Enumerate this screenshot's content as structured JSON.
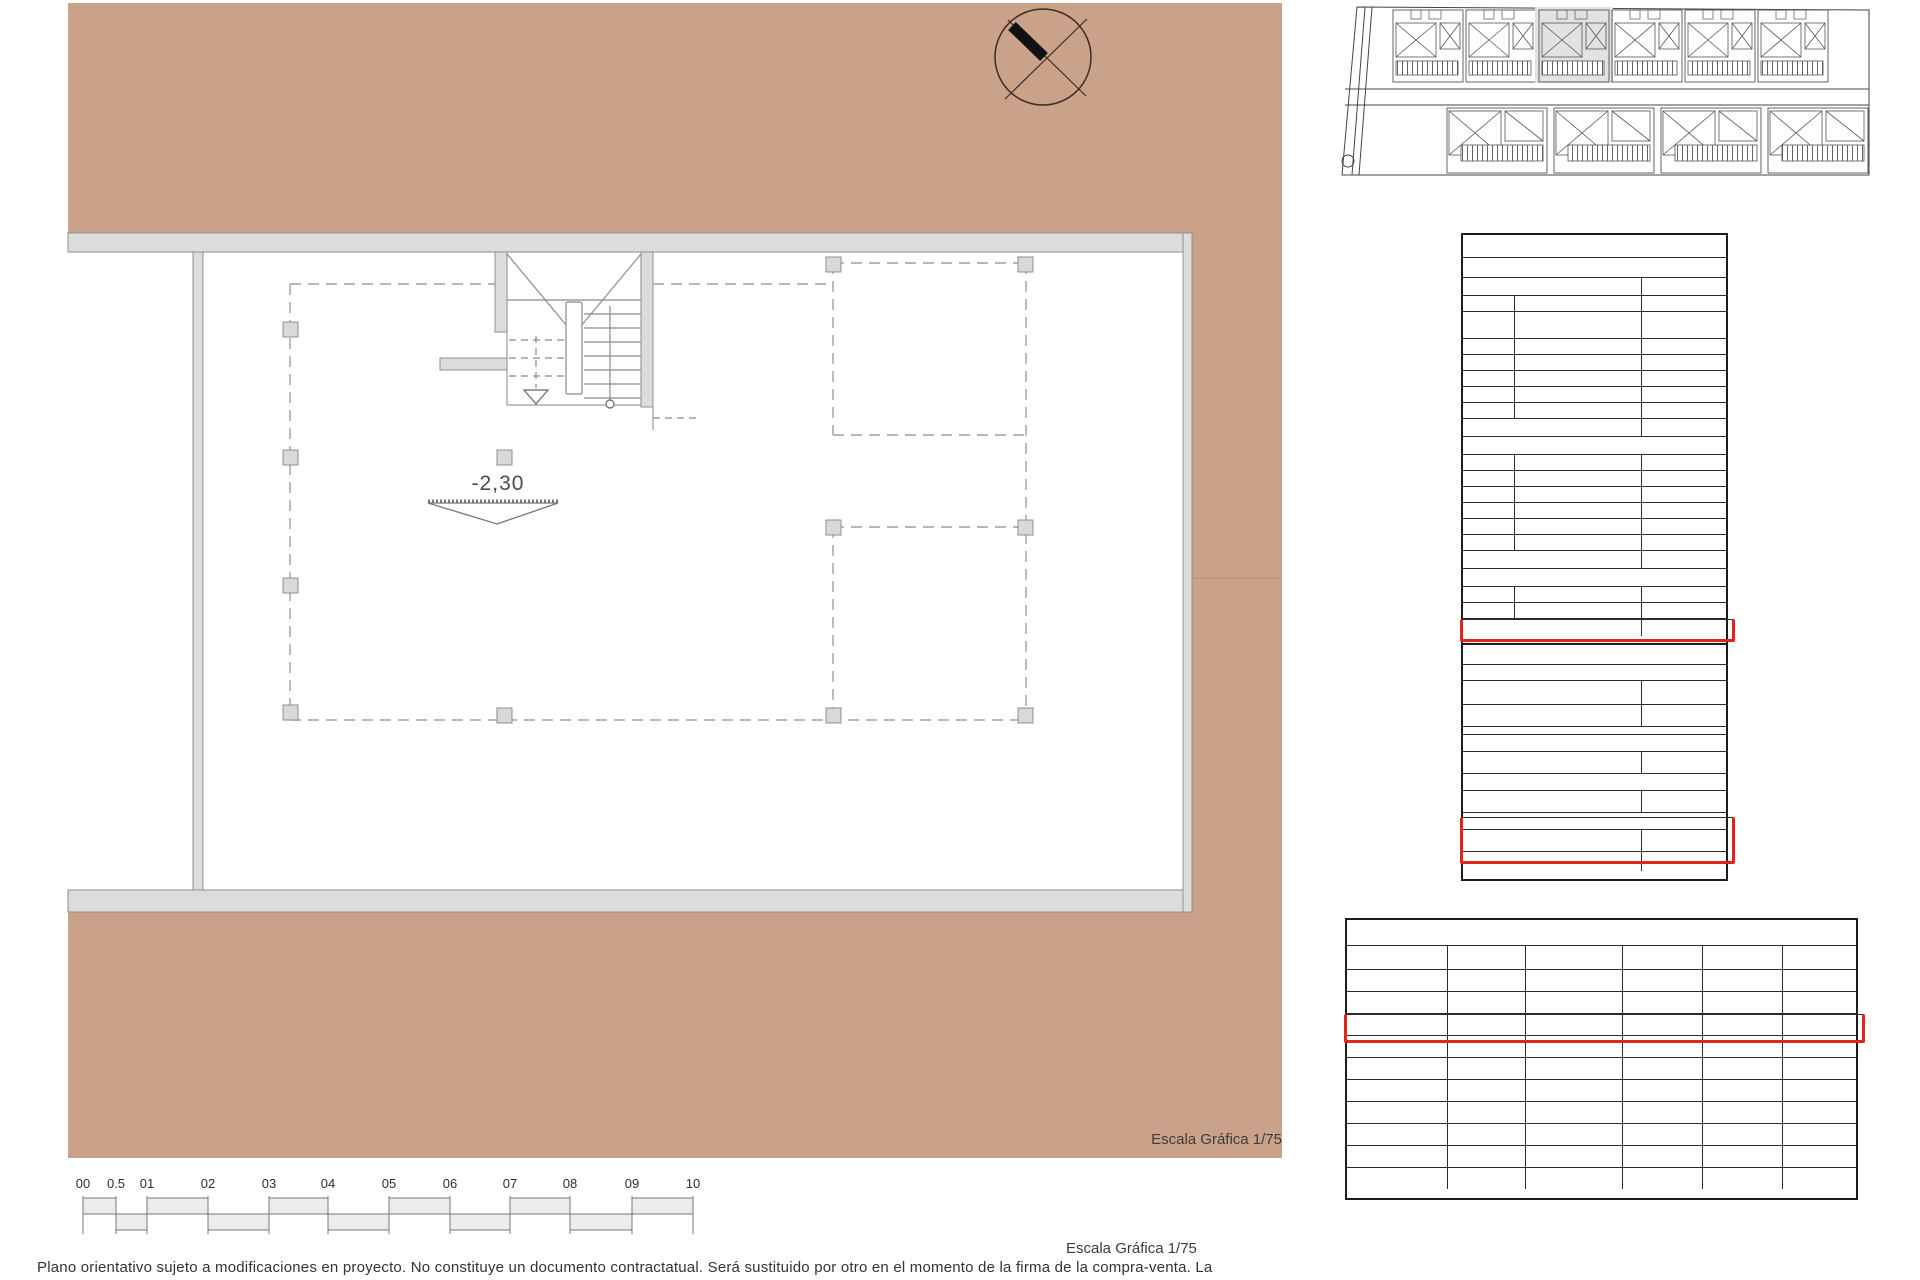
{
  "colors": {
    "terrain_tan": "#caa28a",
    "highlight_red": "#e1251b",
    "wall_gray": "#dcdcdc"
  },
  "plan": {
    "level_label": "-2,30",
    "scale_label": "Escala Gráfica 1/75"
  },
  "scale_bar": {
    "labels": [
      "00",
      "0.5",
      "01",
      "02",
      "03",
      "04",
      "05",
      "06",
      "07",
      "08",
      "09",
      "10"
    ]
  },
  "footer": {
    "scale_label": "Escala Gráfica 1/75",
    "disclaimer": "Plano orientativo sujeto a modificaciones en proyecto. No constituye un documento contractatual. Será sustituido por otro en el momento de la firma de la compra-venta. La"
  },
  "site_plan": {
    "upper_units": 6,
    "lower_units": 4,
    "highlighted_unit": 3
  },
  "tables": {
    "util": {
      "title": "Superficie Útil",
      "subtitle": "Vivienda 3",
      "rows": [
        {
          "type": "section",
          "label": "Planta Baja",
          "value": "m2"
        },
        {
          "type": "item",
          "num": "01",
          "label": "Vestibulo",
          "value": "2.12"
        },
        {
          "type": "item",
          "num": "02",
          "label": "Estar, Cocina, Comedor",
          "value": "37.85",
          "tall": true
        },
        {
          "type": "item",
          "num": "03",
          "label": "Lavadero",
          "value": "3.65"
        },
        {
          "type": "item",
          "num": "04",
          "label": "Baño 1",
          "value": "3.92"
        },
        {
          "type": "item",
          "num": "05",
          "label": "Dormitorio 1",
          "value": "11.02"
        },
        {
          "type": "item",
          "num": "06",
          "label": "Paso, escalera",
          "value": "5.95"
        },
        {
          "type": "item",
          "num": "07",
          "label": "Patio",
          "value": "4.58"
        },
        {
          "type": "total",
          "label": "TOTAL Planta baja",
          "value": "69.09"
        },
        {
          "type": "section",
          "label": "Planta Primera",
          "value": ""
        },
        {
          "type": "item",
          "num": "08",
          "label": "Dormitorio 2",
          "value": "15.08"
        },
        {
          "type": "item",
          "num": "09",
          "label": "Dormitorio 3",
          "value": "12.93"
        },
        {
          "type": "item",
          "num": "10",
          "label": "Baño 02",
          "value": "4.06"
        },
        {
          "type": "item",
          "num": "11",
          "label": "Baño 03",
          "value": "3.62"
        },
        {
          "type": "item",
          "num": "12",
          "label": "Paso + escalera",
          "value": "10.43"
        },
        {
          "type": "item",
          "num": "13",
          "label": "Terraza",
          "value": "15.81"
        },
        {
          "type": "total",
          "label": "TOTAL Planta primera",
          "value": "61.93"
        },
        {
          "type": "section",
          "label": "Planta Sótano",
          "value": ""
        },
        {
          "type": "item",
          "num": "14",
          "label": "Sótano -1",
          "value": "146.42"
        },
        {
          "type": "item",
          "num": "15",
          "label": "Sótano -2",
          "value": "164.85",
          "highlight": true
        },
        {
          "type": "total",
          "label": "TOTAL",
          "value": "442.29"
        }
      ]
    },
    "construida": {
      "title": "Superficie Construida",
      "subtitle": "Vivienda 3",
      "rows": [
        {
          "type": "section",
          "label": "Planta Baja",
          "value": "m2"
        },
        {
          "type": "value",
          "label": "Superficie cerrada",
          "value": "76.52"
        },
        {
          "type": "spacer",
          "label": "",
          "value": ""
        },
        {
          "type": "section",
          "label": "Planta Primera",
          "value": ""
        },
        {
          "type": "value",
          "label": "Superficie cerrada",
          "value": "57.68"
        },
        {
          "type": "section",
          "label": "Planta Sótano -1",
          "value": ""
        },
        {
          "type": "value",
          "label": "Superficie Cerrada",
          "value": "182,68"
        },
        {
          "type": "section",
          "label": "Planta Sótano -2",
          "value": "",
          "highlight": true
        },
        {
          "type": "value",
          "label": "Superficie Cerrada",
          "value": "182,68",
          "highlight": true
        },
        {
          "type": "total",
          "label": "TOTAL Sup. Construida",
          "value": "576.08"
        }
      ]
    },
    "resumen": {
      "title": "SUPERFICIES ÚTILES",
      "columns": [
        "",
        "P. BAJA",
        "P. PRIMERA",
        "SÓTANO -1",
        "SÓTANO -2",
        "TOTAL"
      ],
      "rows": [
        {
          "label": "Vivienda 01",
          "values": [
            "69.09",
            "61.93",
            "128.08",
            "146.35",
            "405.45"
          ]
        },
        {
          "label": "Vivienda 02",
          "values": [
            "69.09",
            "61.93",
            "156.16",
            "175.45",
            "287.18"
          ]
        },
        {
          "label": "Vivienda 03",
          "values": [
            "69.09",
            "61.93",
            "146.42",
            "164.85",
            "277.44"
          ],
          "highlight": true
        },
        {
          "label": "Vivienda 04",
          "values": [
            "69.09",
            "61.93",
            "156.78",
            "",
            "287.80"
          ]
        },
        {
          "label": "Vivienda 05",
          "values": [
            "69.09",
            "61.93",
            "147.04",
            "",
            "278.06"
          ]
        },
        {
          "label": "Vivienda 06",
          "values": [
            "69.09",
            "61.93",
            "172.10",
            "",
            "303.12"
          ]
        },
        {
          "label": "Vivienda 07",
          "values": [
            "111.96",
            "",
            "154.88",
            "",
            "266.84"
          ]
        },
        {
          "label": "Vivienda 08",
          "values": [
            "111.96",
            "",
            "154.88",
            "",
            "266.84"
          ]
        },
        {
          "label": "Vivienda 09",
          "values": [
            "111.96",
            "",
            "154.88",
            "",
            "266.84"
          ]
        },
        {
          "label": "Vivienda 10",
          "values": [
            "111.96",
            "",
            "154.88",
            "154.88",
            "421.72"
          ]
        }
      ]
    }
  }
}
